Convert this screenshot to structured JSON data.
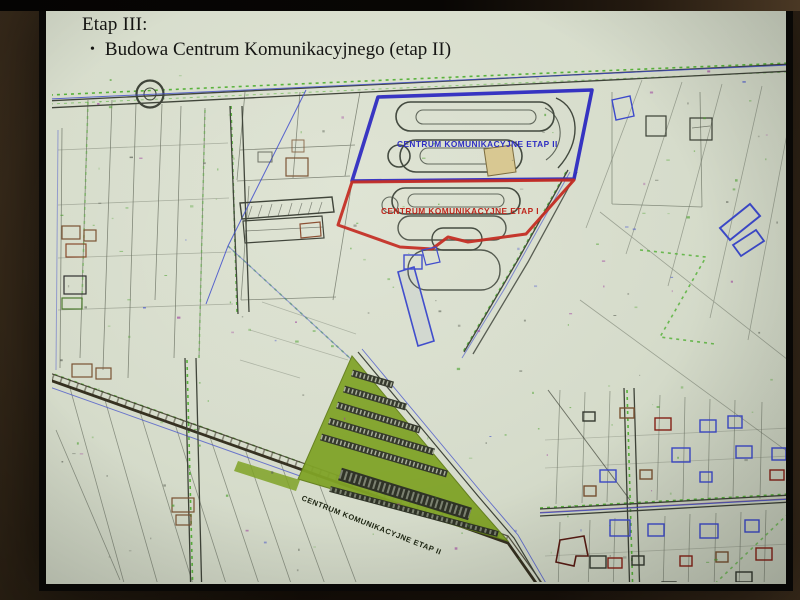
{
  "slide": {
    "title": "Etap III:",
    "bullet_glyph": "•",
    "bullet": "Budowa Centrum Komunikacyjnego (etap II)"
  },
  "map": {
    "labels": {
      "etap2": "CENTRUM KOMUNIKACYJNE ETAP II",
      "etap1": "CENTRUM KOMUNIKACYJNE ETAP I",
      "park_ride": "CENTRUM KOMUNIKACYJNE ETAP II"
    },
    "colors": {
      "etap2_outline": "#2b28c6",
      "etap1_outline": "#c8281e",
      "park_ride_fill": "#7ea321",
      "road_green_dash": "#55b337",
      "utility_blue": "#3b49d0",
      "slide_background": "#d6dccb",
      "photo_frame_brown": "#2a2013"
    }
  }
}
